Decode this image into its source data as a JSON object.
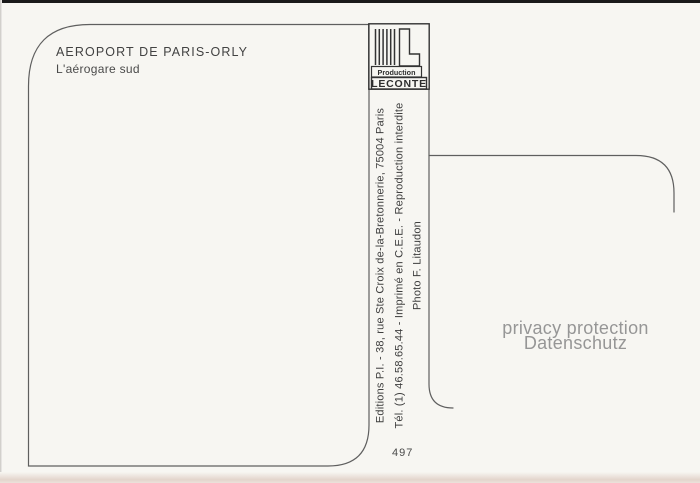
{
  "postcard": {
    "title": "AEROPORT DE PARIS-ORLY",
    "subtitle": "L'aérogare sud",
    "credits": [
      "Editions P.I. - 38, rue Ste Croix de-la-Bretonnerie, 75004 Paris",
      "Tél. (1) 46.58.65.44 - Imprimé en C.E.E. - Reproduction interdite",
      "Photo F. Litaudon"
    ],
    "card_number": "497",
    "logo": {
      "icon": "production-leconte-bars-l-logo",
      "label_top": "Production",
      "label_bottom": "LECONTE"
    },
    "watermark": {
      "line1": "privacy protection",
      "line2": "Datenschutz"
    },
    "colors": {
      "card_background": "#f7f6f2",
      "line_gray": "#5f5f5f",
      "text_dark": "#3e3e3e",
      "watermark_gray": "#969696"
    }
  }
}
